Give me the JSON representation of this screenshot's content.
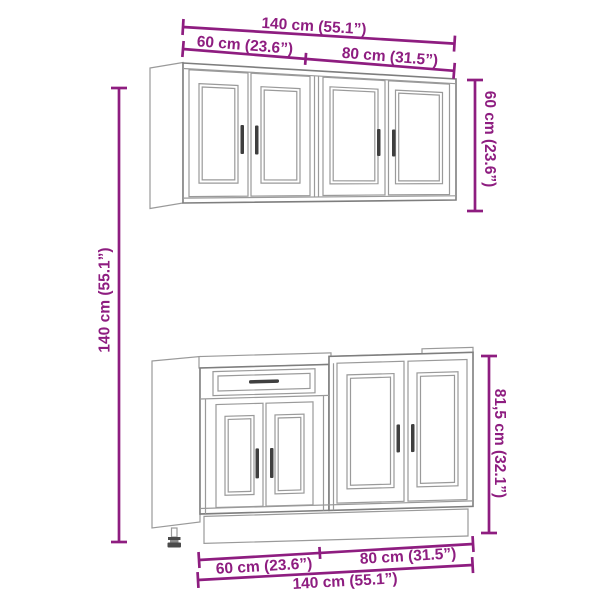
{
  "diagram": {
    "title": "Kitchen cabinet set dimension drawing",
    "style": "line drawing with magenta dimension lines",
    "colors": {
      "dimension": "#8E1D80",
      "outline": "#9A9A9A",
      "outline_strong": "#7E7E7E",
      "handle": "#3F3F3F",
      "background": "#FFFFFF"
    },
    "dims": {
      "wall_total_width": "140 cm (55.1”)",
      "wall_left_width": "60 cm (23.6”)",
      "wall_right_width": "80 cm (31.5”)",
      "wall_height": "60 cm (23.6”)",
      "overall_height": "140 cm (55.1”)",
      "base_height": "81,5 cm (32.1”)",
      "base_left_width": "60 cm (23.6”)",
      "base_right_width": "80 cm (31.5”)",
      "base_total_width": "140 cm (55.1”)"
    }
  }
}
